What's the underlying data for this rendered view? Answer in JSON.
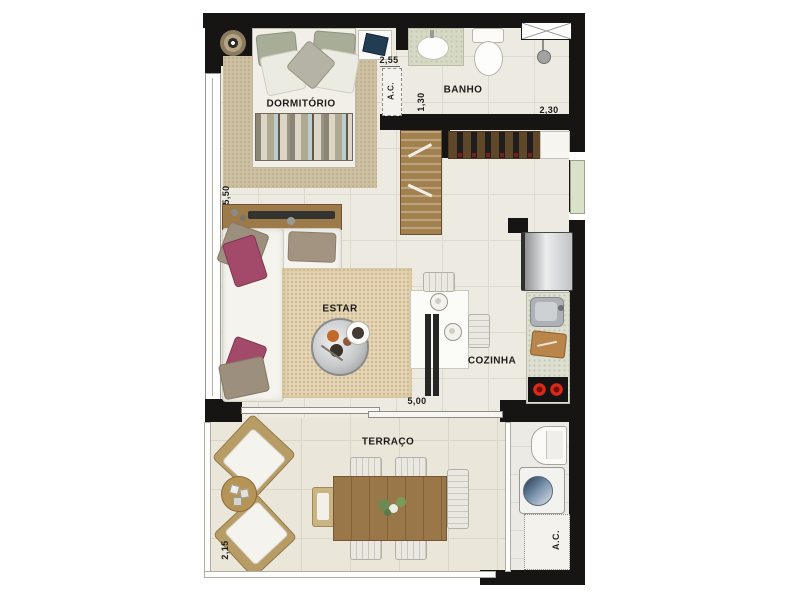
{
  "rooms": {
    "dormitorio": "DORMITÓRIO",
    "banho": "BANHO",
    "estar": "ESTAR",
    "cozinha": "COZINHA",
    "terraco": "TERRAÇO"
  },
  "dims": {
    "bedroom_width": "2,55",
    "bath_depth": "1,30",
    "bath_width": "2,30",
    "side_length": "5,50",
    "living_width": "5,00",
    "terrace_depth": "2,15"
  },
  "labels": {
    "ac": "A.C."
  },
  "colors": {
    "wall": "#161513",
    "floor": "#edeae2",
    "terrace_floor": "#eae6da",
    "bedroom_rug": "#cdc0a2",
    "living_rug": "#e5d5b5",
    "wood": "#9c7a4a",
    "dark_wood": "#6e5230",
    "accent_pillow": "#a34a6a",
    "counter": "#dde0d0",
    "burner_red": "#d92b1c",
    "door_glass": "#d9e2c8",
    "washer_door_blue": "#2e4a6a"
  }
}
